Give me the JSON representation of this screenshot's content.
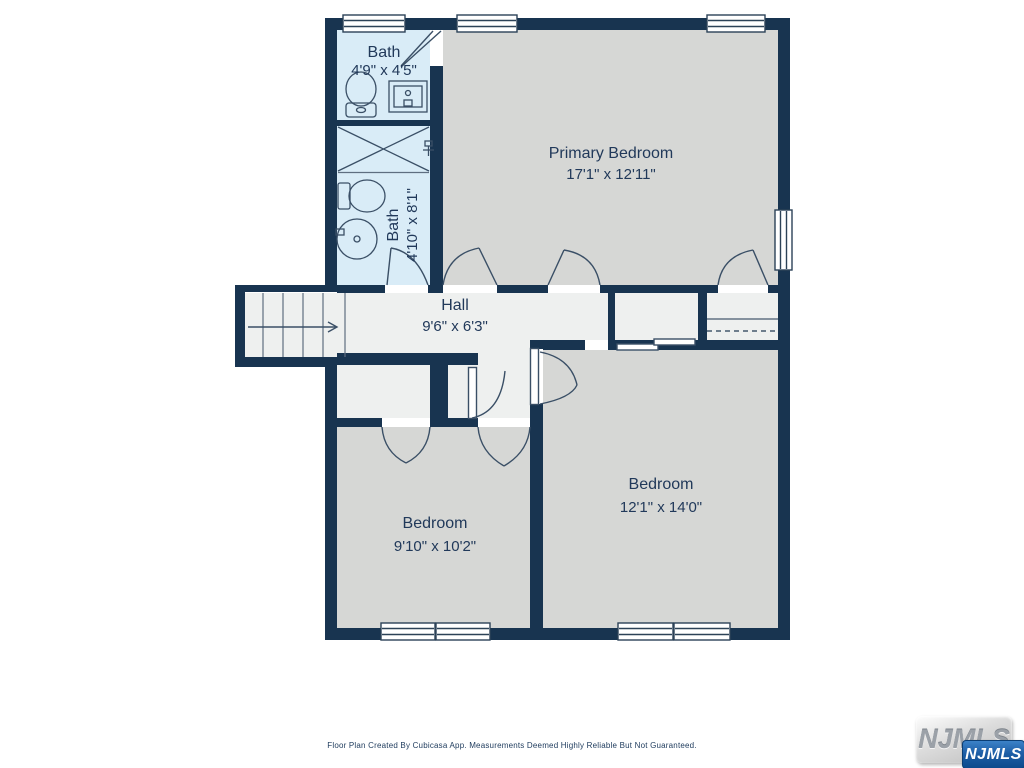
{
  "rooms": {
    "bath_top": {
      "name": "Bath",
      "dims": "4'9\" x 4'5\""
    },
    "bath_side": {
      "name": "Bath",
      "dims": "4'10\" x 8'1\""
    },
    "primary_bedroom": {
      "name": "Primary Bedroom",
      "dims": "17'1\" x 12'11\""
    },
    "hall": {
      "name": "Hall",
      "dims": "9'6\" x 6'3\""
    },
    "bedroom_left": {
      "name": "Bedroom",
      "dims": "9'10\" x 10'2\""
    },
    "bedroom_right": {
      "name": "Bedroom",
      "dims": "12'1\" x 14'0\""
    }
  },
  "footer": {
    "disclaimer": "Floor Plan Created By Cubicasa App. Measurements Deemed Highly Reliable But Not Guaranteed."
  },
  "watermark": {
    "plate_text": "NJMLS",
    "badge_text": "NJMLS"
  },
  "colors": {
    "wall": "#183450",
    "bedroom_fill": "#d6d7d5",
    "hall_fill": "#eef0ef",
    "bath_fill": "#d9ecf7",
    "label_text": "#21395a",
    "line": "#3a4f66"
  }
}
